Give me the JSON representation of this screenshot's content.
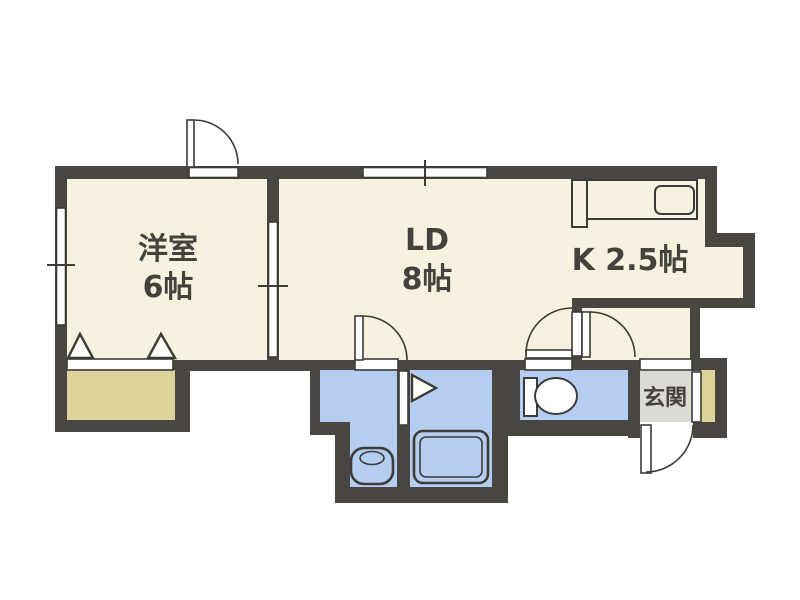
{
  "palette": {
    "wall": "#494641",
    "floor": "#f7f1e0",
    "wet": "#b5cdf1",
    "tan": "#dcd39a",
    "gray": "#dbdad5",
    "line": "#3d3b36",
    "text": "#45423d",
    "bg": "#ffffff"
  },
  "rooms": {
    "western": {
      "name": "洋室",
      "size": "6帖"
    },
    "living_dining": {
      "name": "LD",
      "size": "8帖"
    },
    "kitchen": {
      "name": "K 2.5帖"
    },
    "entrance": {
      "name": "玄関"
    }
  }
}
